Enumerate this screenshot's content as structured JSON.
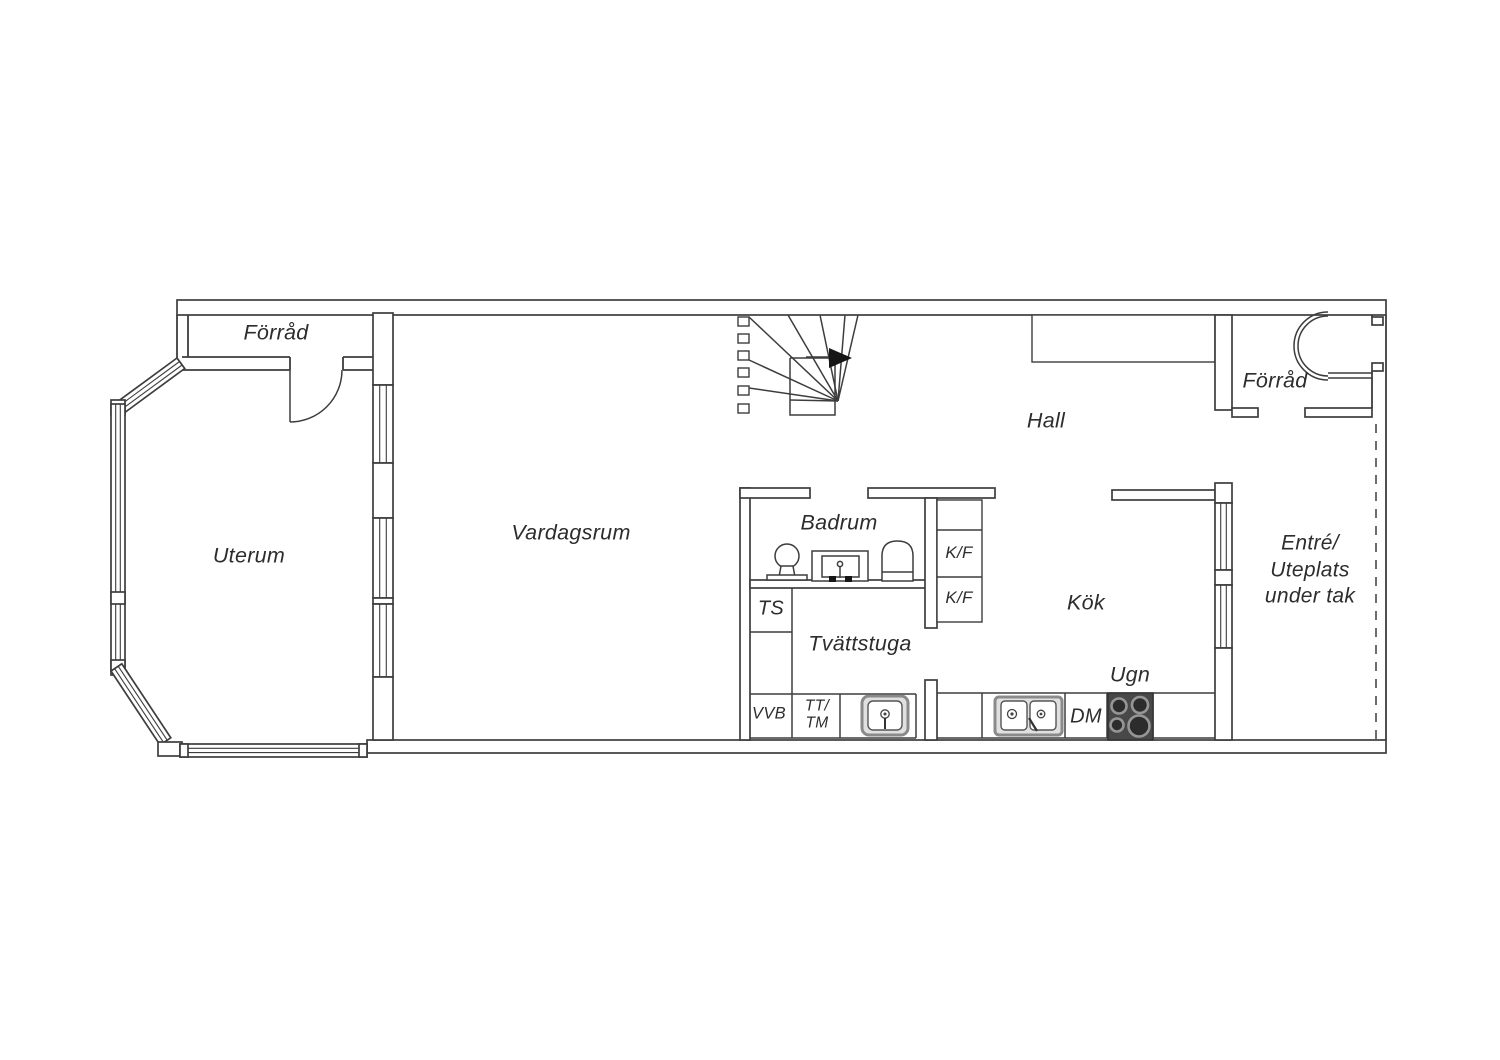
{
  "plan": {
    "type": "floor-plan",
    "rooms": {
      "forrad_tl": "Förråd",
      "uterum": "Uterum",
      "vardagsrum": "Vardagsrum",
      "hall": "Hall",
      "badrum": "Badrum",
      "tvattstuga": "Tvättstuga",
      "kok": "Kök",
      "forrad_tr": "Förråd"
    },
    "entre": {
      "line1": "Entré/",
      "line2": "Uteplats",
      "line3": "under tak"
    },
    "appliances": {
      "kf_upper": "K/F",
      "kf_lower": "K/F",
      "ts": "TS",
      "vvb": "VVB",
      "tt": "TT/",
      "tm": "TM",
      "dm": "DM",
      "ugn": "Ugn"
    },
    "colors": {
      "line": "#3d3d3d",
      "text": "#2d2d2d",
      "stove_body": "#484848",
      "burner": "#2c2c2c",
      "burner_ring": "#969696",
      "appliance_gray": "#e0e0e0"
    }
  }
}
